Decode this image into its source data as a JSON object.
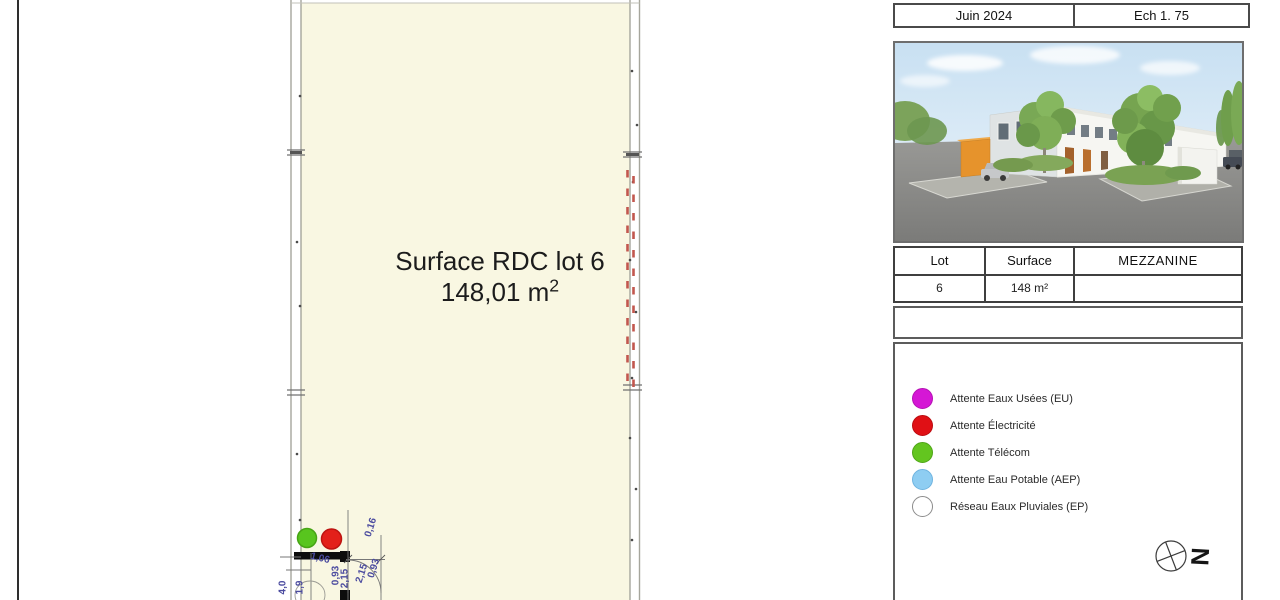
{
  "title_block": {
    "date": "Juin 2024",
    "scale": "Ech 1. 75"
  },
  "plan": {
    "room_label": "Surface RDC lot 6",
    "area_value": "148,01 m",
    "area_exponent": "2",
    "markers": [
      {
        "name": "attente-telecom-marker",
        "color": "#58c51e",
        "stroke": "#46a414"
      },
      {
        "name": "attente-electricite-marker",
        "color": "#e3201a",
        "stroke": "#bd1411"
      }
    ],
    "dimensions": [
      {
        "text": "4,0",
        "x": 283,
        "y": 589,
        "rot": -90
      },
      {
        "text": "1,9",
        "x": 300,
        "y": 589,
        "rot": -90
      },
      {
        "text": "1,06",
        "x": 320,
        "y": 560,
        "rot": 14
      },
      {
        "text": "0,93",
        "x": 336,
        "y": 577,
        "rot": -90
      },
      {
        "text": "2,15",
        "x": 345,
        "y": 580,
        "rot": -90
      },
      {
        "text": "0,16",
        "x": 371,
        "y": 529,
        "rot": -72
      },
      {
        "text": "2,15",
        "x": 362,
        "y": 575,
        "rot": -72
      },
      {
        "text": "0,93",
        "x": 374,
        "y": 570,
        "rot": -72
      }
    ]
  },
  "table": {
    "headers": [
      "Lot",
      "Surface",
      "MEZZANINE"
    ],
    "rows": [
      [
        "6",
        "148 m²",
        ""
      ]
    ]
  },
  "legend": {
    "items": [
      {
        "icon": "eaux-usees-dot-icon",
        "label": "Attente Eaux Usées (EU)",
        "color": "#d517d5",
        "stroke": "#b512b5"
      },
      {
        "icon": "electricite-dot-icon",
        "label": "Attente Électricité",
        "color": "#e01015",
        "stroke": "#bb0c10"
      },
      {
        "icon": "telecom-dot-icon",
        "label": "Attente Télécom",
        "color": "#63c51f",
        "stroke": "#4fa517"
      },
      {
        "icon": "eau-potable-dot-icon",
        "label": "Attente Eau Potable (AEP)",
        "color": "#8ecdf2",
        "stroke": "#6fb4e0"
      },
      {
        "icon": "eaux-pluviales-dot-icon",
        "label": "Réseau Eaux Pluviales (EP)",
        "color": "#ffffff",
        "stroke": "#8c8c8c"
      }
    ]
  },
  "compass": {
    "letter": "N"
  },
  "colors": {
    "plan-fill": "#f9f7e2",
    "wall": "#a6a69c",
    "red-dash": "#c2574e",
    "dim-text": "#4b4b9f",
    "border-dark": "#4a4a4a",
    "panel-border": "#5c5c5c"
  }
}
